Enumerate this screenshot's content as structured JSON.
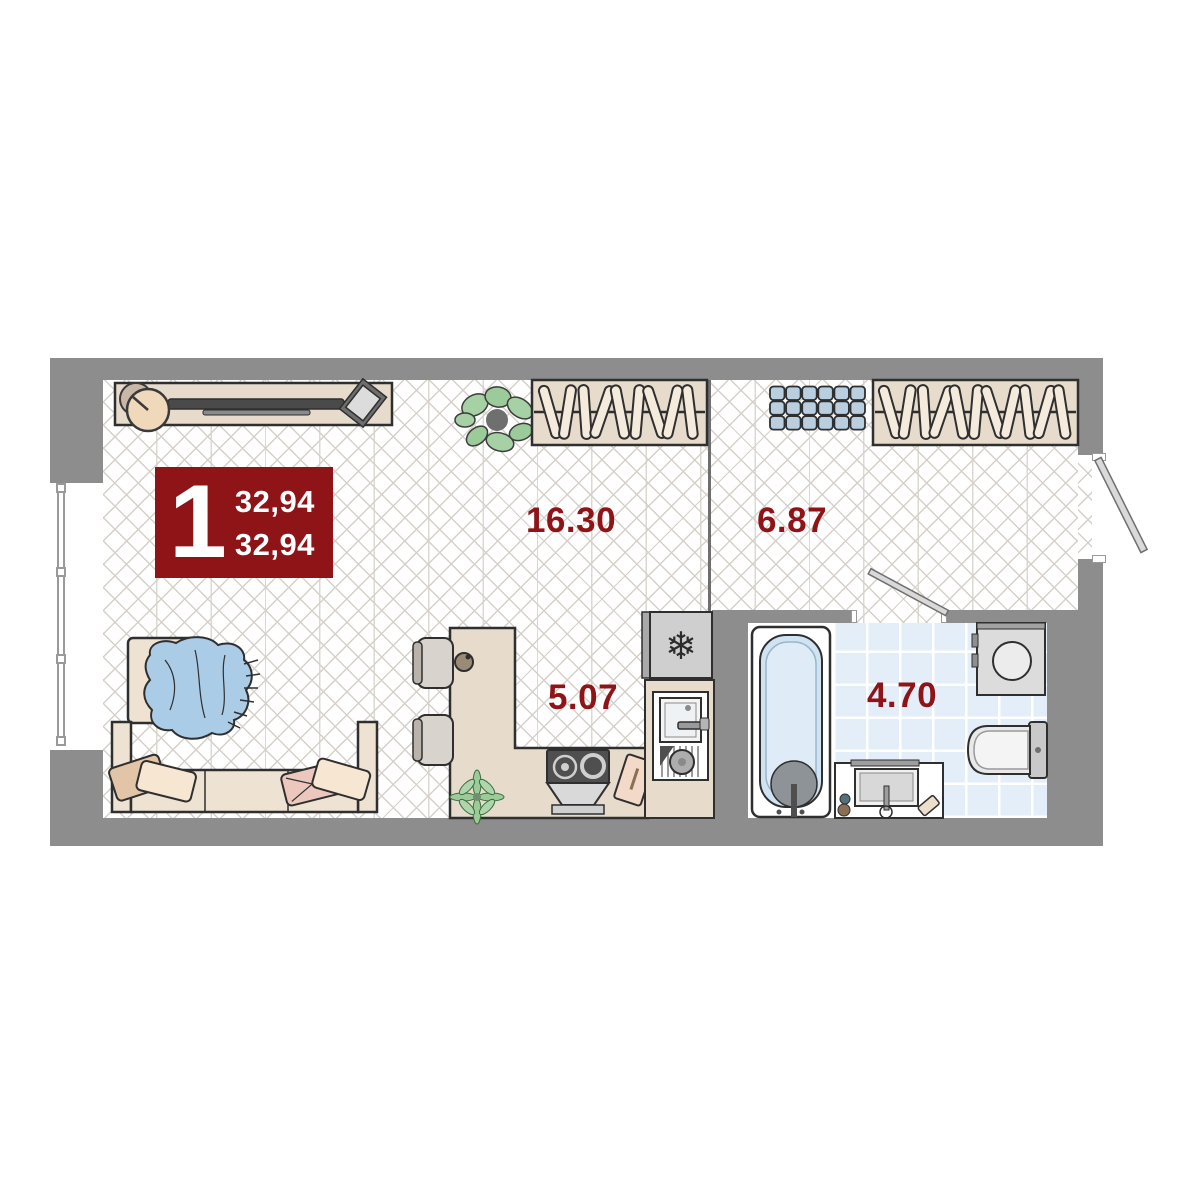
{
  "badge": {
    "rooms_count": "1",
    "area_line1": "32,94",
    "area_line2": "32,94"
  },
  "rooms": {
    "living": {
      "area": "16.30"
    },
    "hallway": {
      "area": "6.87"
    },
    "kitchen": {
      "area": "5.07"
    },
    "bathroom": {
      "area": "4.70"
    }
  },
  "icons": {
    "fridge_icon": "❄"
  },
  "furniture": {
    "wardrobe_living_hangers": 9,
    "wardrobe_hall_hangers": 11,
    "hall_boxes": {
      "rows": 3,
      "cols": 6
    }
  },
  "colors": {
    "accent_red": "#8E1418",
    "wall_gray": "#8D8D8D",
    "tile_blue": "#E3EEF8",
    "furniture_beige": "#E7DBCB",
    "water_blue": "#CFE3F2",
    "box_blue": "#B9CFDF",
    "outline_dark": "#2F2F2F"
  }
}
